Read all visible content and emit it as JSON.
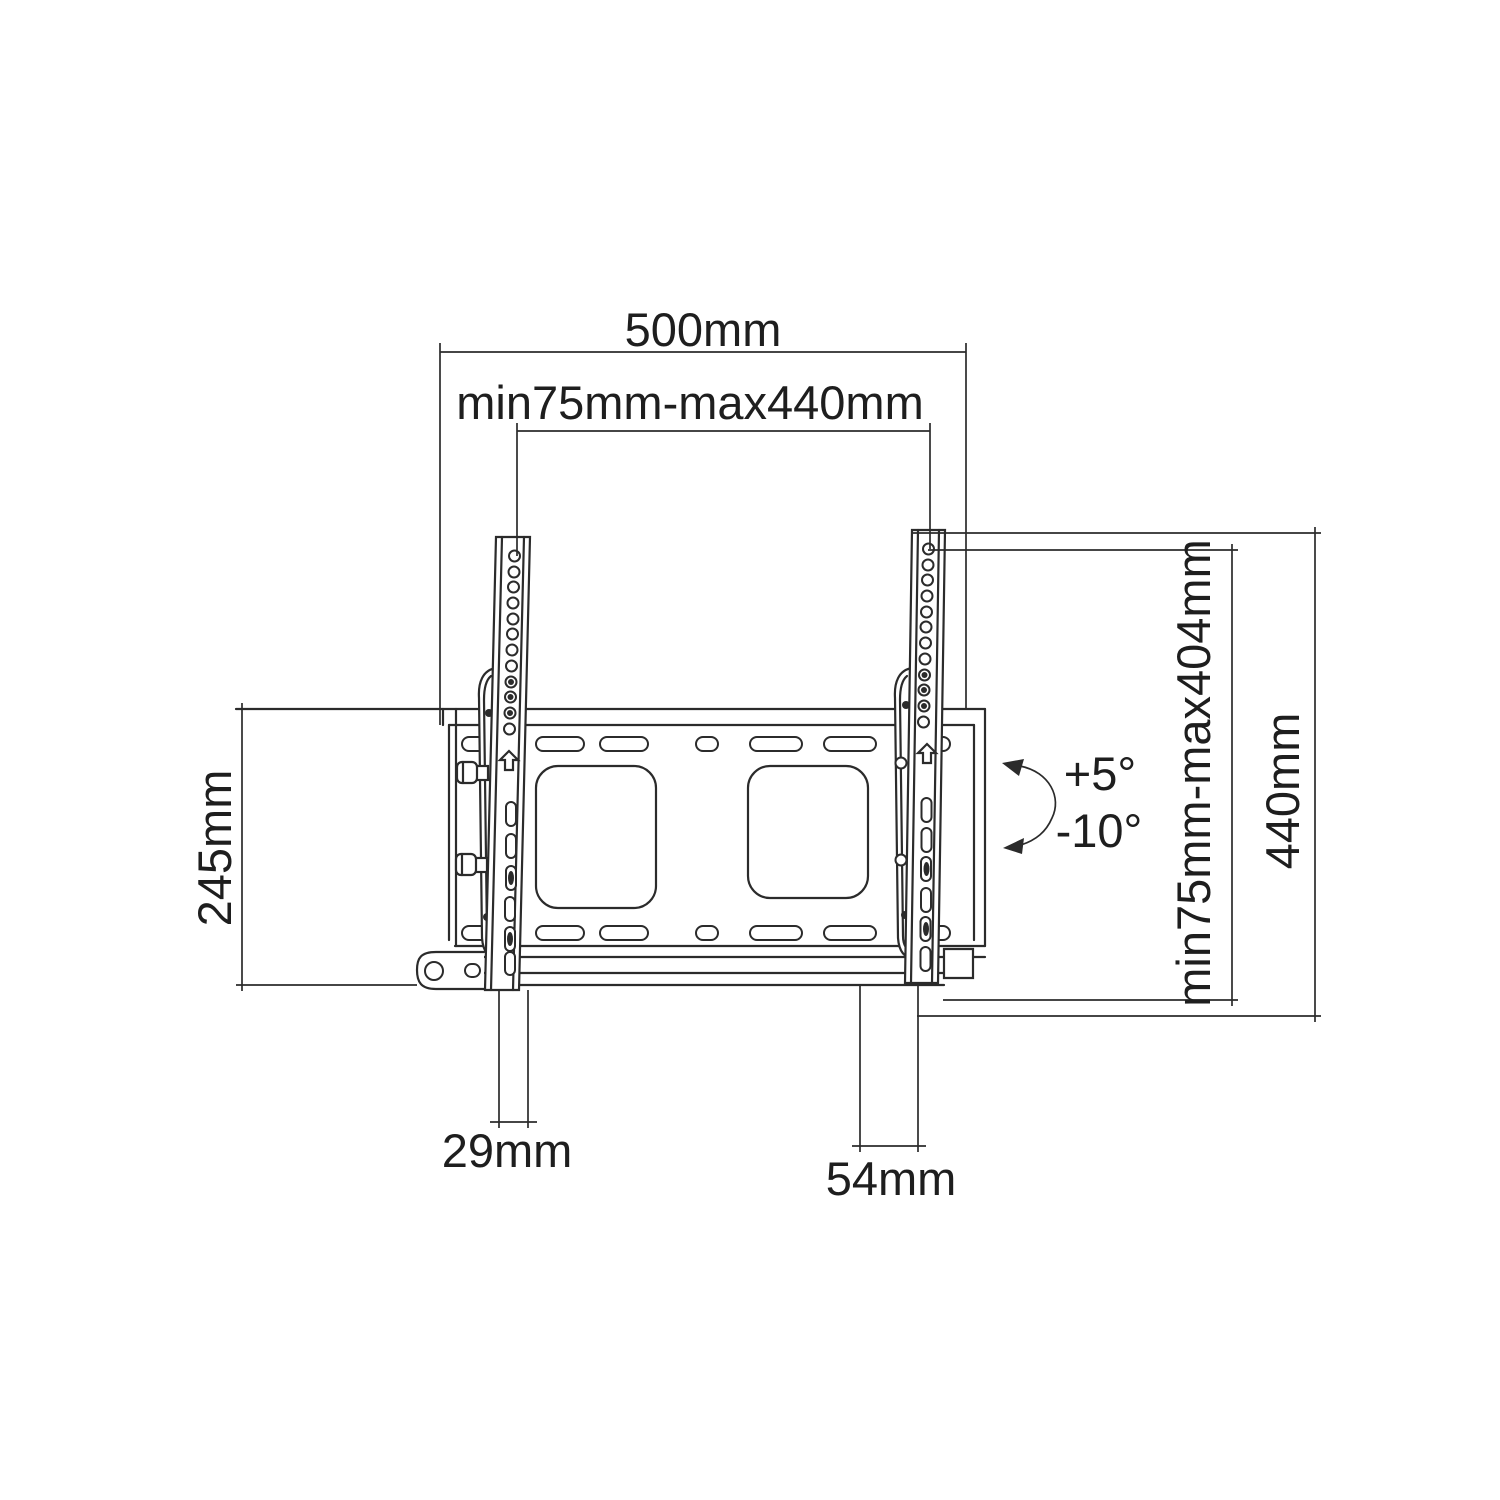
{
  "page": {
    "background_color": "#ffffff",
    "line_color": "#2b2b2b",
    "text_color": "#1e1e1e"
  },
  "diagram": {
    "type": "technical-drawing",
    "subject": "Tilting TV wall mount bracket dimensional diagram",
    "labels": {
      "overall_width": "500mm",
      "mount_width_range": "min75mm-max440mm",
      "wall_plate_height": "245mm",
      "mount_height_range": "min75mm-max404mm",
      "overall_height": "440mm",
      "rail_depth": "29mm",
      "mount_depth": "54mm",
      "tilt_up": "+5°",
      "tilt_down": "-10°"
    }
  }
}
